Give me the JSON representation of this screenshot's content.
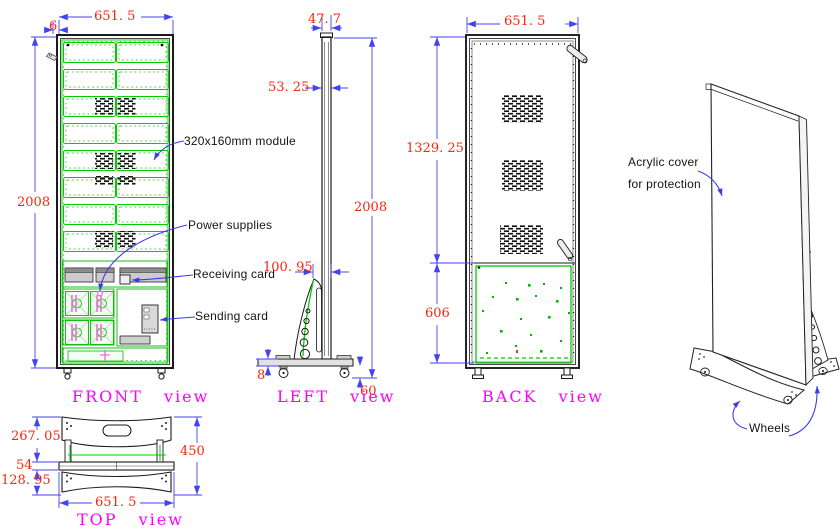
{
  "front": {
    "title": "FRONT view",
    "dims": {
      "width": "651. 5",
      "frame_offset": "6",
      "height": "2008"
    },
    "callouts": {
      "module": "320x160mm module",
      "power": "Power supplies",
      "receiving": "Receiving card",
      "sending": "Sending card"
    }
  },
  "left": {
    "title": "LEFT view",
    "dims": {
      "top_width": "47. 7",
      "panel_depth": "53. 25",
      "height": "2008",
      "stand_depth": "100. 95",
      "plate_thickness": "8",
      "wheel_height": "60"
    }
  },
  "back": {
    "title": "BACK view",
    "dims": {
      "width": "651. 5",
      "upper_section": "1329. 25",
      "door_section": "606"
    }
  },
  "top": {
    "title": "TOP view",
    "dims": {
      "front_foot_depth": "267. 05",
      "cabinet_depth": "54",
      "rear_foot_depth": "128. 95",
      "total_depth": "450",
      "width": "651. 5"
    }
  },
  "iso": {
    "callouts": {
      "cover_line1": "Acrylic cover",
      "cover_line2": "for protection",
      "wheels": "Wheels"
    }
  },
  "colors": {
    "dimension_text": "#f9260f",
    "dimension_line": "#4343f0",
    "module_green": "#00cc00",
    "view_title": "#ff00ff",
    "outline": "#1a1a1a",
    "psu_accent": "#f26fd8"
  }
}
